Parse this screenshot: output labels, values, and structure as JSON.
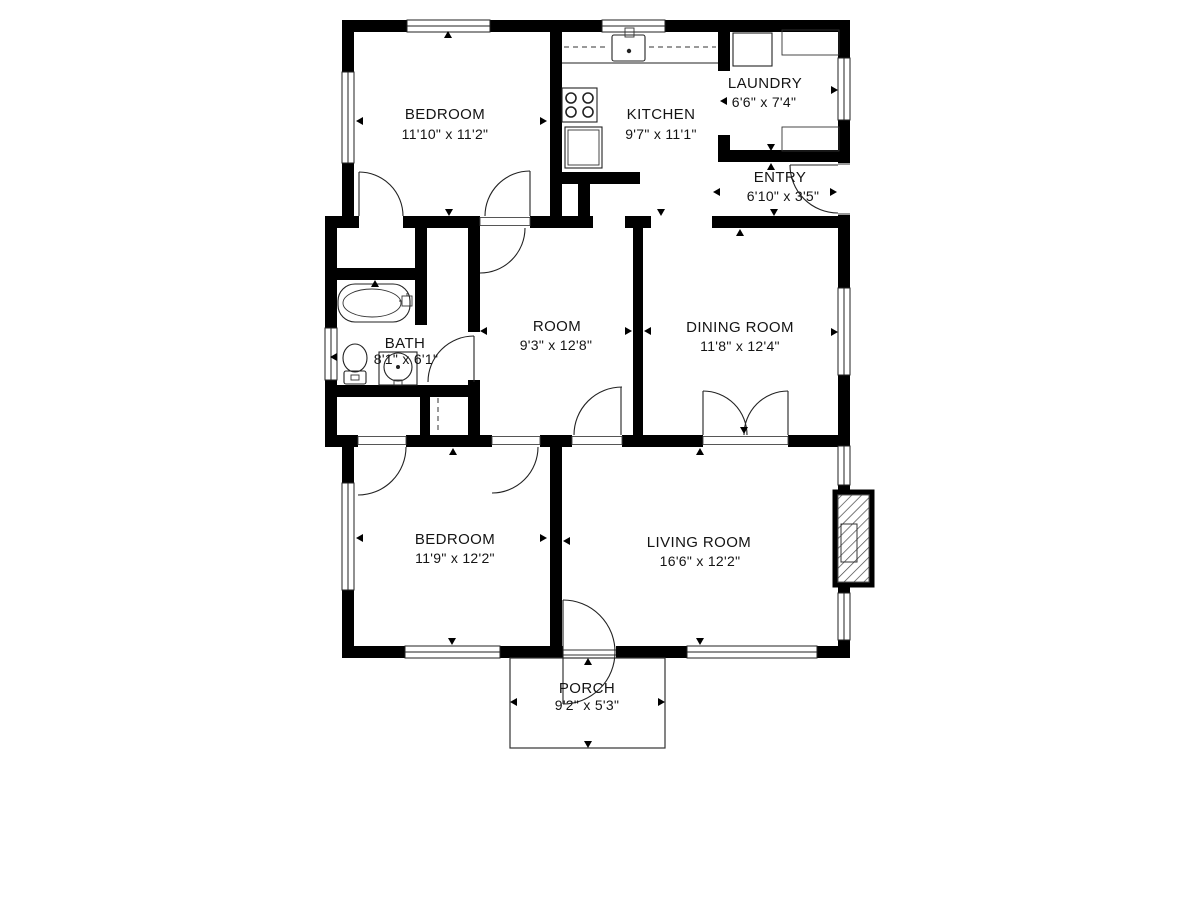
{
  "floor_plan": {
    "colors": {
      "background": "#ffffff",
      "walls": "#000000",
      "lines": "#222222"
    },
    "rooms": [
      {
        "id": "bedroom-1",
        "name": "BEDROOM",
        "dimensions": "11'10\" x 11'2\""
      },
      {
        "id": "kitchen",
        "name": "KITCHEN",
        "dimensions": "9'7\" x 11'1\""
      },
      {
        "id": "laundry",
        "name": "LAUNDRY",
        "dimensions": "6'6\" x 7'4\""
      },
      {
        "id": "entry",
        "name": "ENTRY",
        "dimensions": "6'10\" x 3'5\""
      },
      {
        "id": "bath",
        "name": "BATH",
        "dimensions": "8'1\" x 6'1\""
      },
      {
        "id": "room",
        "name": "ROOM",
        "dimensions": "9'3\" x 12'8\""
      },
      {
        "id": "dining-room",
        "name": "DINING ROOM",
        "dimensions": "11'8\" x 12'4\""
      },
      {
        "id": "bedroom-2",
        "name": "BEDROOM",
        "dimensions": "11'9\" x 12'2\""
      },
      {
        "id": "living-room",
        "name": "LIVING ROOM",
        "dimensions": "16'6\" x 12'2\""
      },
      {
        "id": "porch",
        "name": "PORCH",
        "dimensions": "9'2\" x 5'3\""
      }
    ],
    "fixtures": [
      "bathtub",
      "toilet",
      "bath-sink",
      "stove",
      "kitchen-sink",
      "kitchen-counter",
      "refrigerator",
      "washer",
      "laundry-counter",
      "fireplace"
    ]
  }
}
